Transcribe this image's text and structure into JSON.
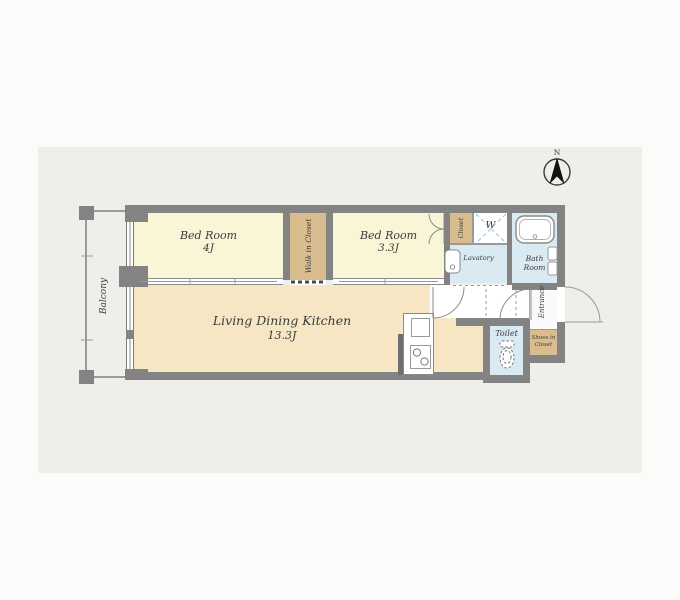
{
  "compass": {
    "north_label": "N"
  },
  "rooms": {
    "bedroom1": {
      "name": "Bed Room",
      "size": "4J"
    },
    "bedroom2": {
      "name": "Bed Room",
      "size": "3.3J"
    },
    "ldk": {
      "name": "Living Dining Kitchen",
      "size": "13.3J"
    },
    "walk_in_closet": {
      "name": "Walk in Closet"
    },
    "closet": {
      "name": "Closet"
    },
    "washer_space": {
      "name": "W"
    },
    "lavatory": {
      "name": "Lavatory"
    },
    "bathroom": {
      "line1": "Bath",
      "line2": "Room"
    },
    "toilet": {
      "name": "Toilet"
    },
    "entrance": {
      "name": "Entrance"
    },
    "shoes_closet": {
      "line1": "Shoes in",
      "line2": "Closet"
    },
    "balcony": {
      "name": "Balcony"
    }
  },
  "colors": {
    "background_band": "#efeeeb",
    "page": "#fbfbfa",
    "wall": "#838383",
    "bedroom_floor": "#f9f5d7",
    "ldk_floor": "#f6e6c4",
    "closet_floor": "#d9bd8e",
    "wet_area_floor": "#d9eaf3",
    "hallway_floor": "#ffffff",
    "label_text": "#3b3b3b"
  }
}
